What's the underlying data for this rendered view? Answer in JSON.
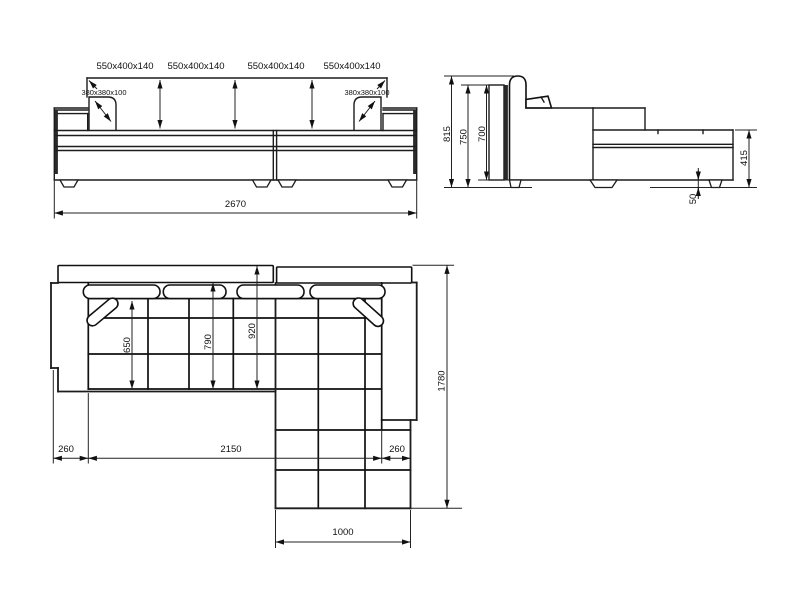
{
  "drawing": "corner-sofa-dimension-drawing",
  "front_view": {
    "cushion_labels": [
      "550x400x140",
      "550x400x140",
      "550x400x140",
      "550x400x140"
    ],
    "pillow_labels": [
      "380x380x100",
      "380x380x100"
    ],
    "overall_width": "2670"
  },
  "side_view": {
    "total_height": "815",
    "back_height": "750",
    "frame_height": "700",
    "chaise_height": "415",
    "floor_clearance": "50"
  },
  "plan_view": {
    "seat_depth": "650",
    "inner_depth": "790",
    "outer_depth": "920",
    "total_depth": "1780",
    "left_armrest_width": "260",
    "seat_width": "2150",
    "right_armrest_width": "260",
    "chaise_width": "1000"
  },
  "colors": {
    "line": "#1c1c1c",
    "dark_fill": "#2a2a2a",
    "background": "#ffffff"
  }
}
